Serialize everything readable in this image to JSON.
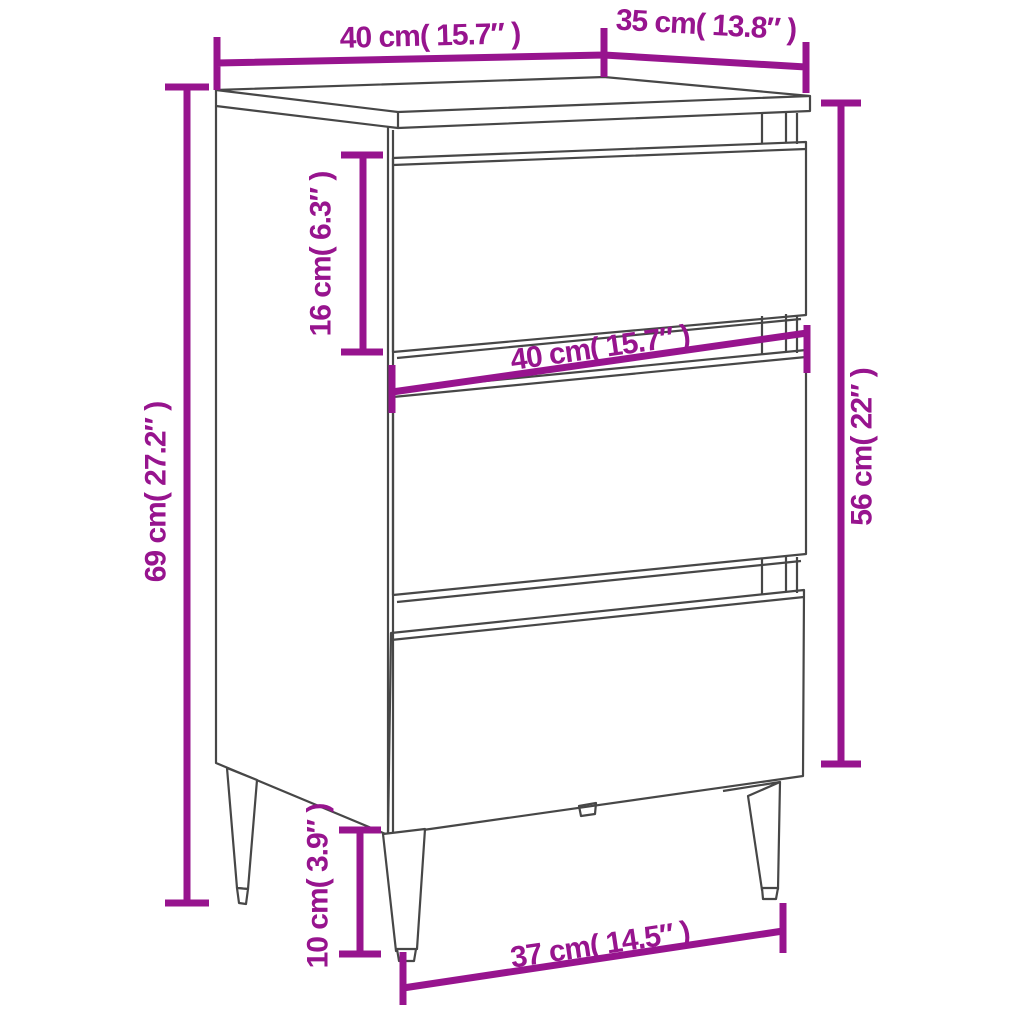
{
  "diagram": {
    "kind": "product-dimension-diagram",
    "product": "bedside cabinet with 3 drawers and metal legs",
    "background_color": "#ffffff",
    "accent_color": "#97148E",
    "line_color": "#474747",
    "dims": {
      "top_width": {
        "label": "40 cm( 15.7″ )",
        "value_cm": 40,
        "value_in": 15.7
      },
      "top_depth": {
        "label": "35 cm( 13.8″ )",
        "value_cm": 35,
        "value_in": 13.8
      },
      "height_total": {
        "label": "69 cm( 27.2″ )",
        "value_cm": 69,
        "value_in": 27.2
      },
      "drawer_height": {
        "label": "16 cm( 6.3″ )",
        "value_cm": 16,
        "value_in": 6.3
      },
      "front_width": {
        "label": "40 cm( 15.7″ )",
        "value_cm": 40,
        "value_in": 15.7
      },
      "body_height": {
        "label": "56 cm( 22″ )",
        "value_cm": 56,
        "value_in": 22
      },
      "leg_height": {
        "label": "10 cm( 3.9″ )",
        "value_cm": 10,
        "value_in": 3.9
      },
      "feet_span": {
        "label": "37 cm( 14.5″ )",
        "value_cm": 37,
        "value_in": 14.5
      }
    }
  }
}
